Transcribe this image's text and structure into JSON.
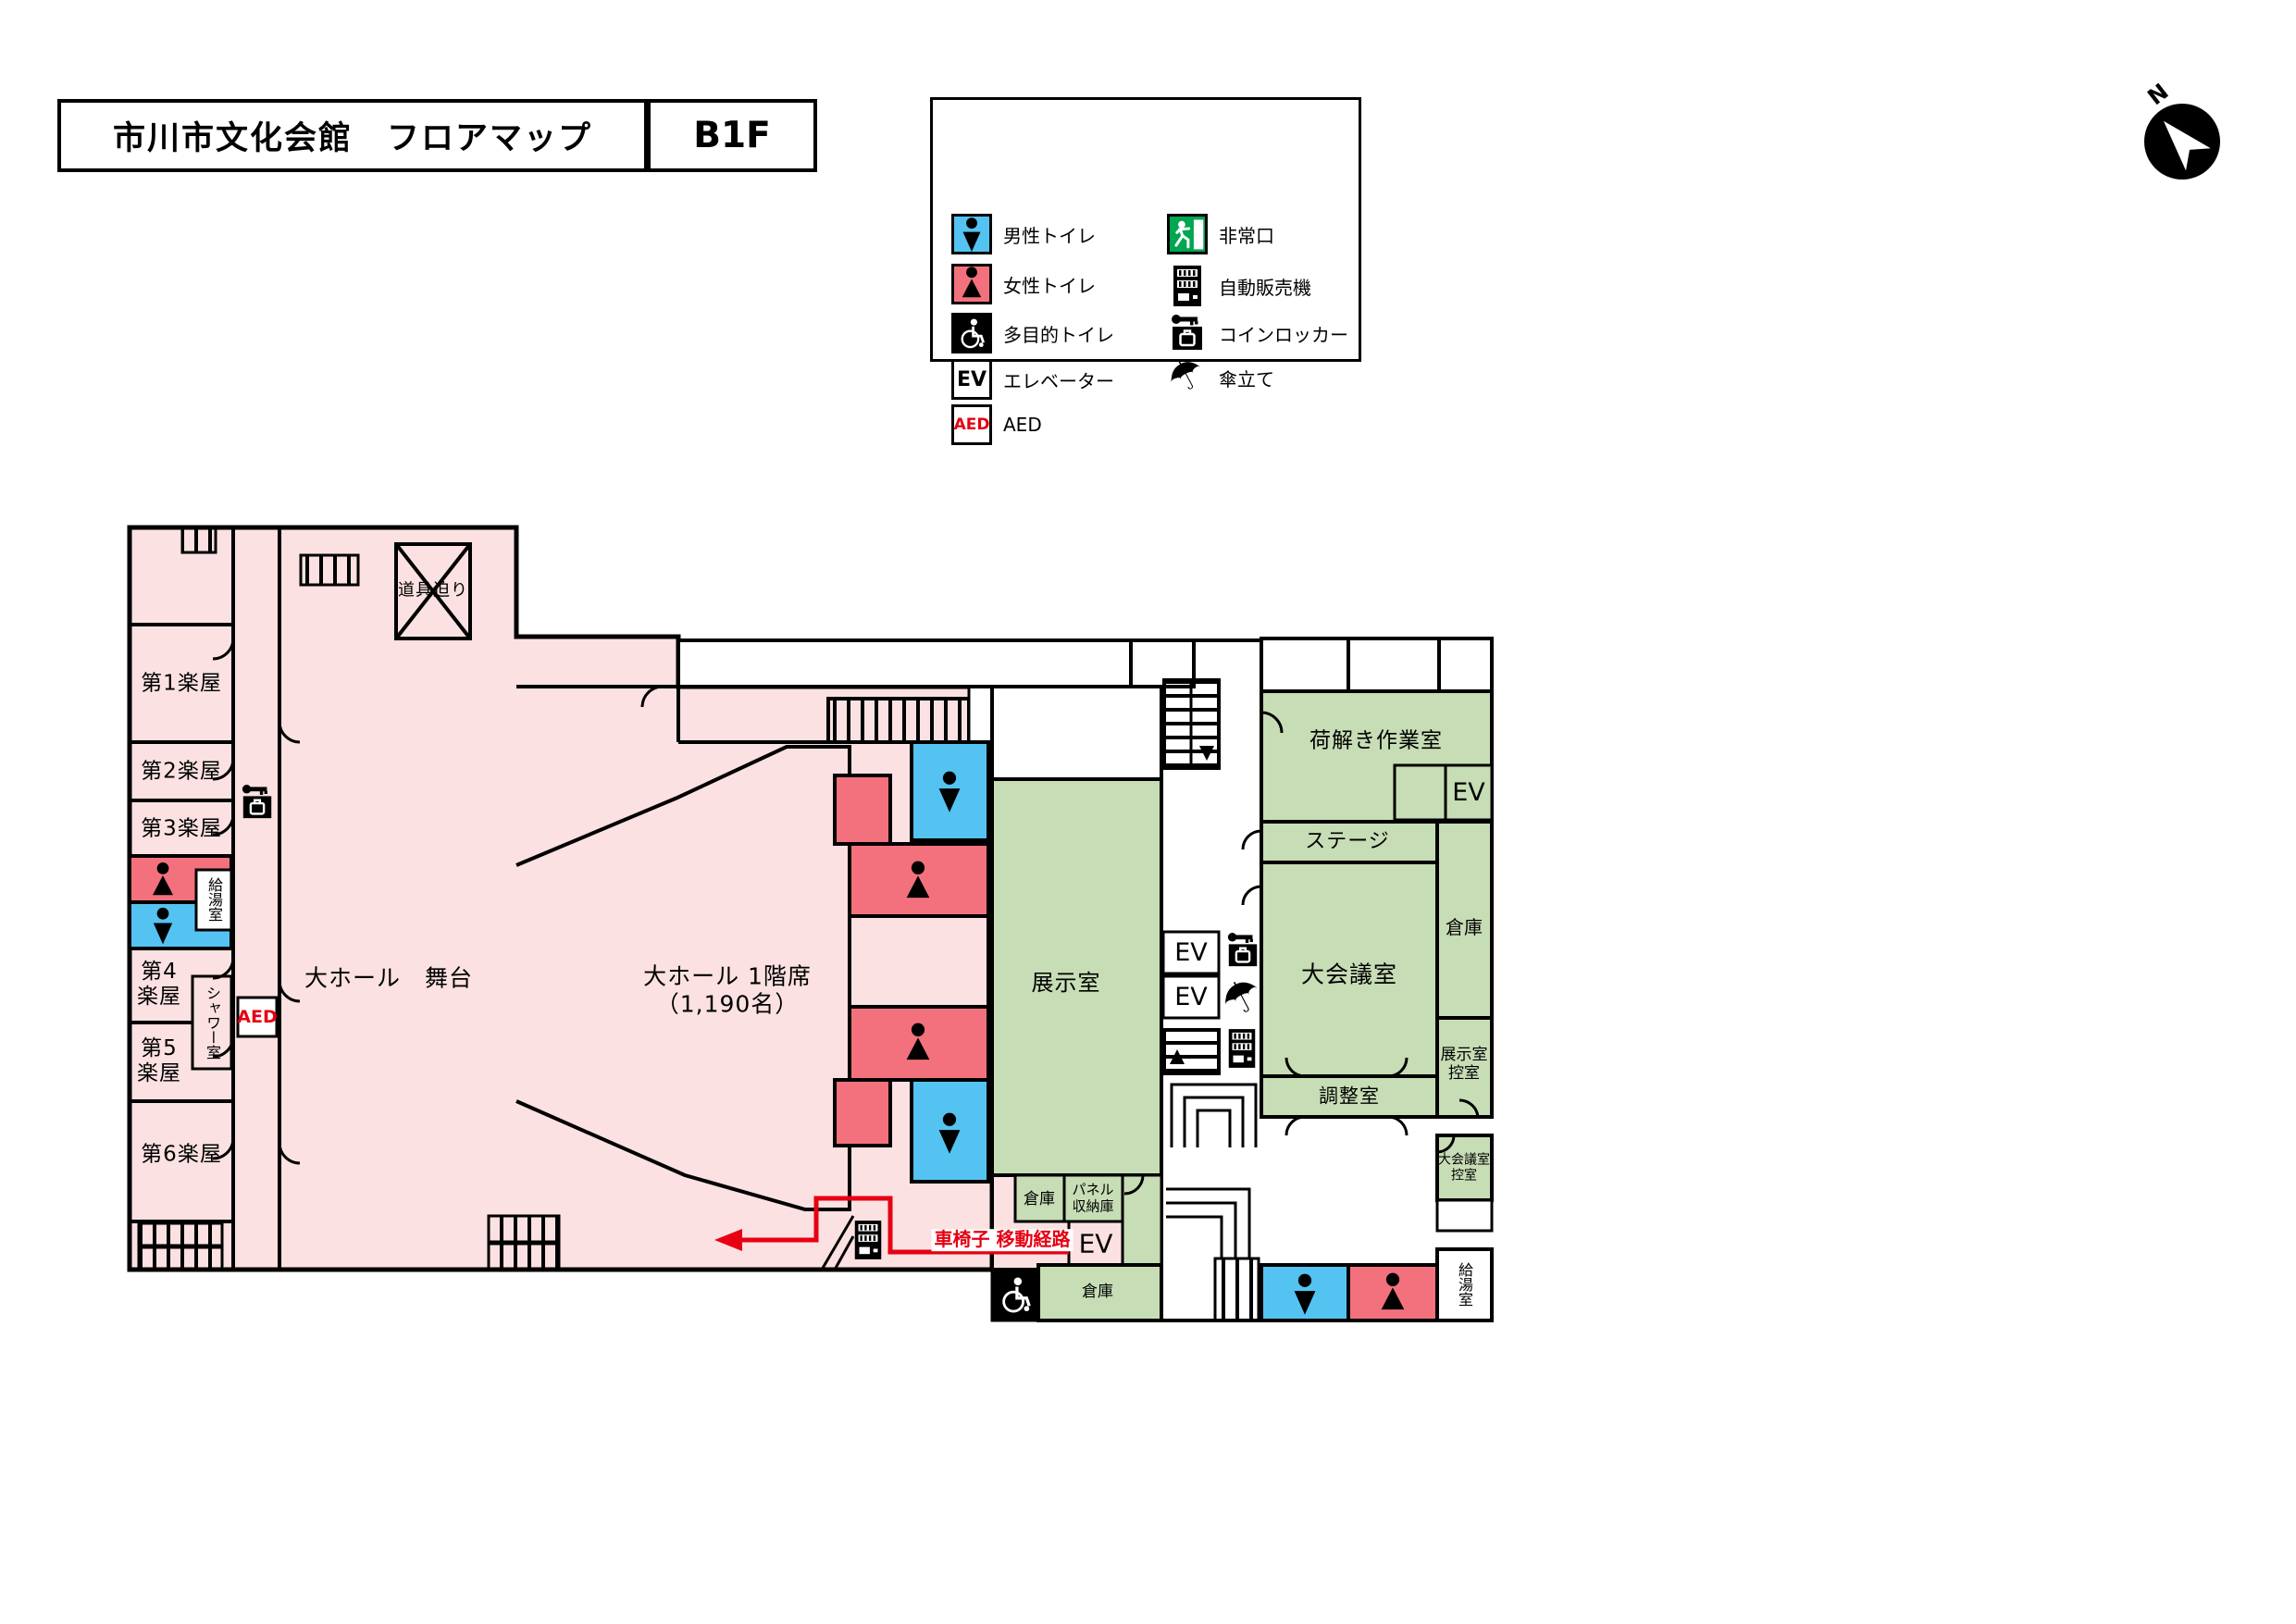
{
  "header": {
    "title": "市川市文化会館　フロアマップ",
    "floor": "B1F"
  },
  "compass": {
    "label": "N"
  },
  "colors": {
    "room_pink": "#fbe1e1",
    "toilet_red": "#f3717d",
    "toilet_blue": "#54c3f1",
    "room_green": "#c7ddb5",
    "exit_green": "#00a650",
    "accent_red": "#e60012",
    "wall_black": "#000000"
  },
  "legend": {
    "left": [
      {
        "icon": "male-toilet-icon",
        "label": "男性トイレ"
      },
      {
        "icon": "female-toilet-icon",
        "label": "女性トイレ"
      },
      {
        "icon": "accessible-toilet-icon",
        "label": "多目的トイレ"
      },
      {
        "icon": "elevator-icon",
        "label": "エレベーター"
      },
      {
        "icon": "aed-icon",
        "label": "AED"
      }
    ],
    "right": [
      {
        "icon": "emergency-exit-icon",
        "label": "非常口"
      },
      {
        "icon": "vending-machine-icon",
        "label": "自動販売機"
      },
      {
        "icon": "coin-locker-icon",
        "label": "コインロッカー"
      },
      {
        "icon": "umbrella-stand-icon",
        "label": "傘立て"
      }
    ]
  },
  "labels": {
    "ev": "EV",
    "aed": "AED"
  },
  "rooms": {
    "gakuya1": "第1楽屋",
    "gakuya2": "第2楽屋",
    "gakuya3": "第3楽屋",
    "gakuya4": "第4\n楽屋",
    "gakuya5": "第5\n楽屋",
    "gakuya6": "第6楽屋",
    "kyuto_left": "給湯室",
    "shower": "シャワー室",
    "dogu_seri": "道具迫り",
    "butai": "大ホール　舞台",
    "seats": "大ホール 1階席\n（1,190名）",
    "tenjishitsu": "展示室",
    "soko_mid": "倉庫",
    "panel_shuno": "パネル\n収納庫",
    "soko_bottom": "倉庫",
    "kurumaisu_route": "車椅子 移動経路",
    "niotoki": "荷解き作業室",
    "stage_strip": "ステージ",
    "daikaigi": "大会議室",
    "soko_right": "倉庫",
    "tenji_hikae": "展示室\n控室",
    "chosei": "調整室",
    "daikaigi_hikae": "大会議室\n控室",
    "kyuto_right": "給湯室"
  }
}
